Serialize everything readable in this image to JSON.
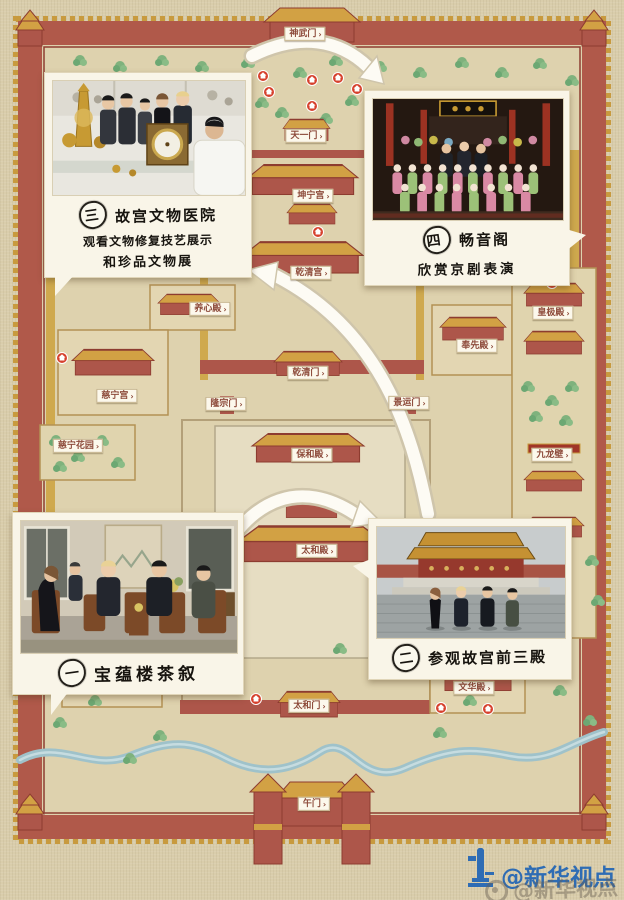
{
  "map": {
    "chevron": "›",
    "labels": [
      {
        "id": "shenwumen",
        "text": "神武门"
      },
      {
        "id": "tianyimen",
        "text": "天一门"
      },
      {
        "id": "kunninggong",
        "text": "坤宁宫"
      },
      {
        "id": "qianqinggong",
        "text": "乾清宫"
      },
      {
        "id": "yangxindian",
        "text": "养心殿"
      },
      {
        "id": "huangjidian",
        "text": "皇极殿"
      },
      {
        "id": "fengxiandian",
        "text": "奉先殿"
      },
      {
        "id": "qianqingmen",
        "text": "乾清门"
      },
      {
        "id": "cininggong",
        "text": "慈宁宫"
      },
      {
        "id": "longzongmen",
        "text": "隆宗门"
      },
      {
        "id": "jingyunmen",
        "text": "景运门"
      },
      {
        "id": "cininghuayuan",
        "text": "慈宁花园"
      },
      {
        "id": "jiulongbi",
        "text": "九龙壁"
      },
      {
        "id": "baohedian",
        "text": "保和殿"
      },
      {
        "id": "taihedian",
        "text": "太和殿"
      },
      {
        "id": "wuyingdian",
        "text": "武英殿"
      },
      {
        "id": "wenhuadian",
        "text": "文华殿"
      },
      {
        "id": "taihemen",
        "text": "太和门"
      },
      {
        "id": "wumen",
        "text": "午门"
      }
    ]
  },
  "stops": [
    {
      "number": "一",
      "lines": [
        "宝蕴楼茶叙"
      ]
    },
    {
      "number": "二",
      "lines": [
        "参观故宫前三殿"
      ]
    },
    {
      "number": "三",
      "lines": [
        "故宫文物医院",
        "观看文物修复技艺展示",
        "和珍品文物展"
      ]
    },
    {
      "number": "四",
      "lines": [
        "畅音阁",
        "欣赏京剧表演"
      ]
    }
  ],
  "watermark": {
    "handle": "@新华视点",
    "ghost_handle": "@新华视点"
  },
  "colors": {
    "wall_red": "#b0594a",
    "roof_gold": "#d2a144",
    "ground": "#d9cdab",
    "marker_red": "#d6402c",
    "river_blue": "#9fc2ca",
    "watermark_blue": "#2e6cb4"
  }
}
